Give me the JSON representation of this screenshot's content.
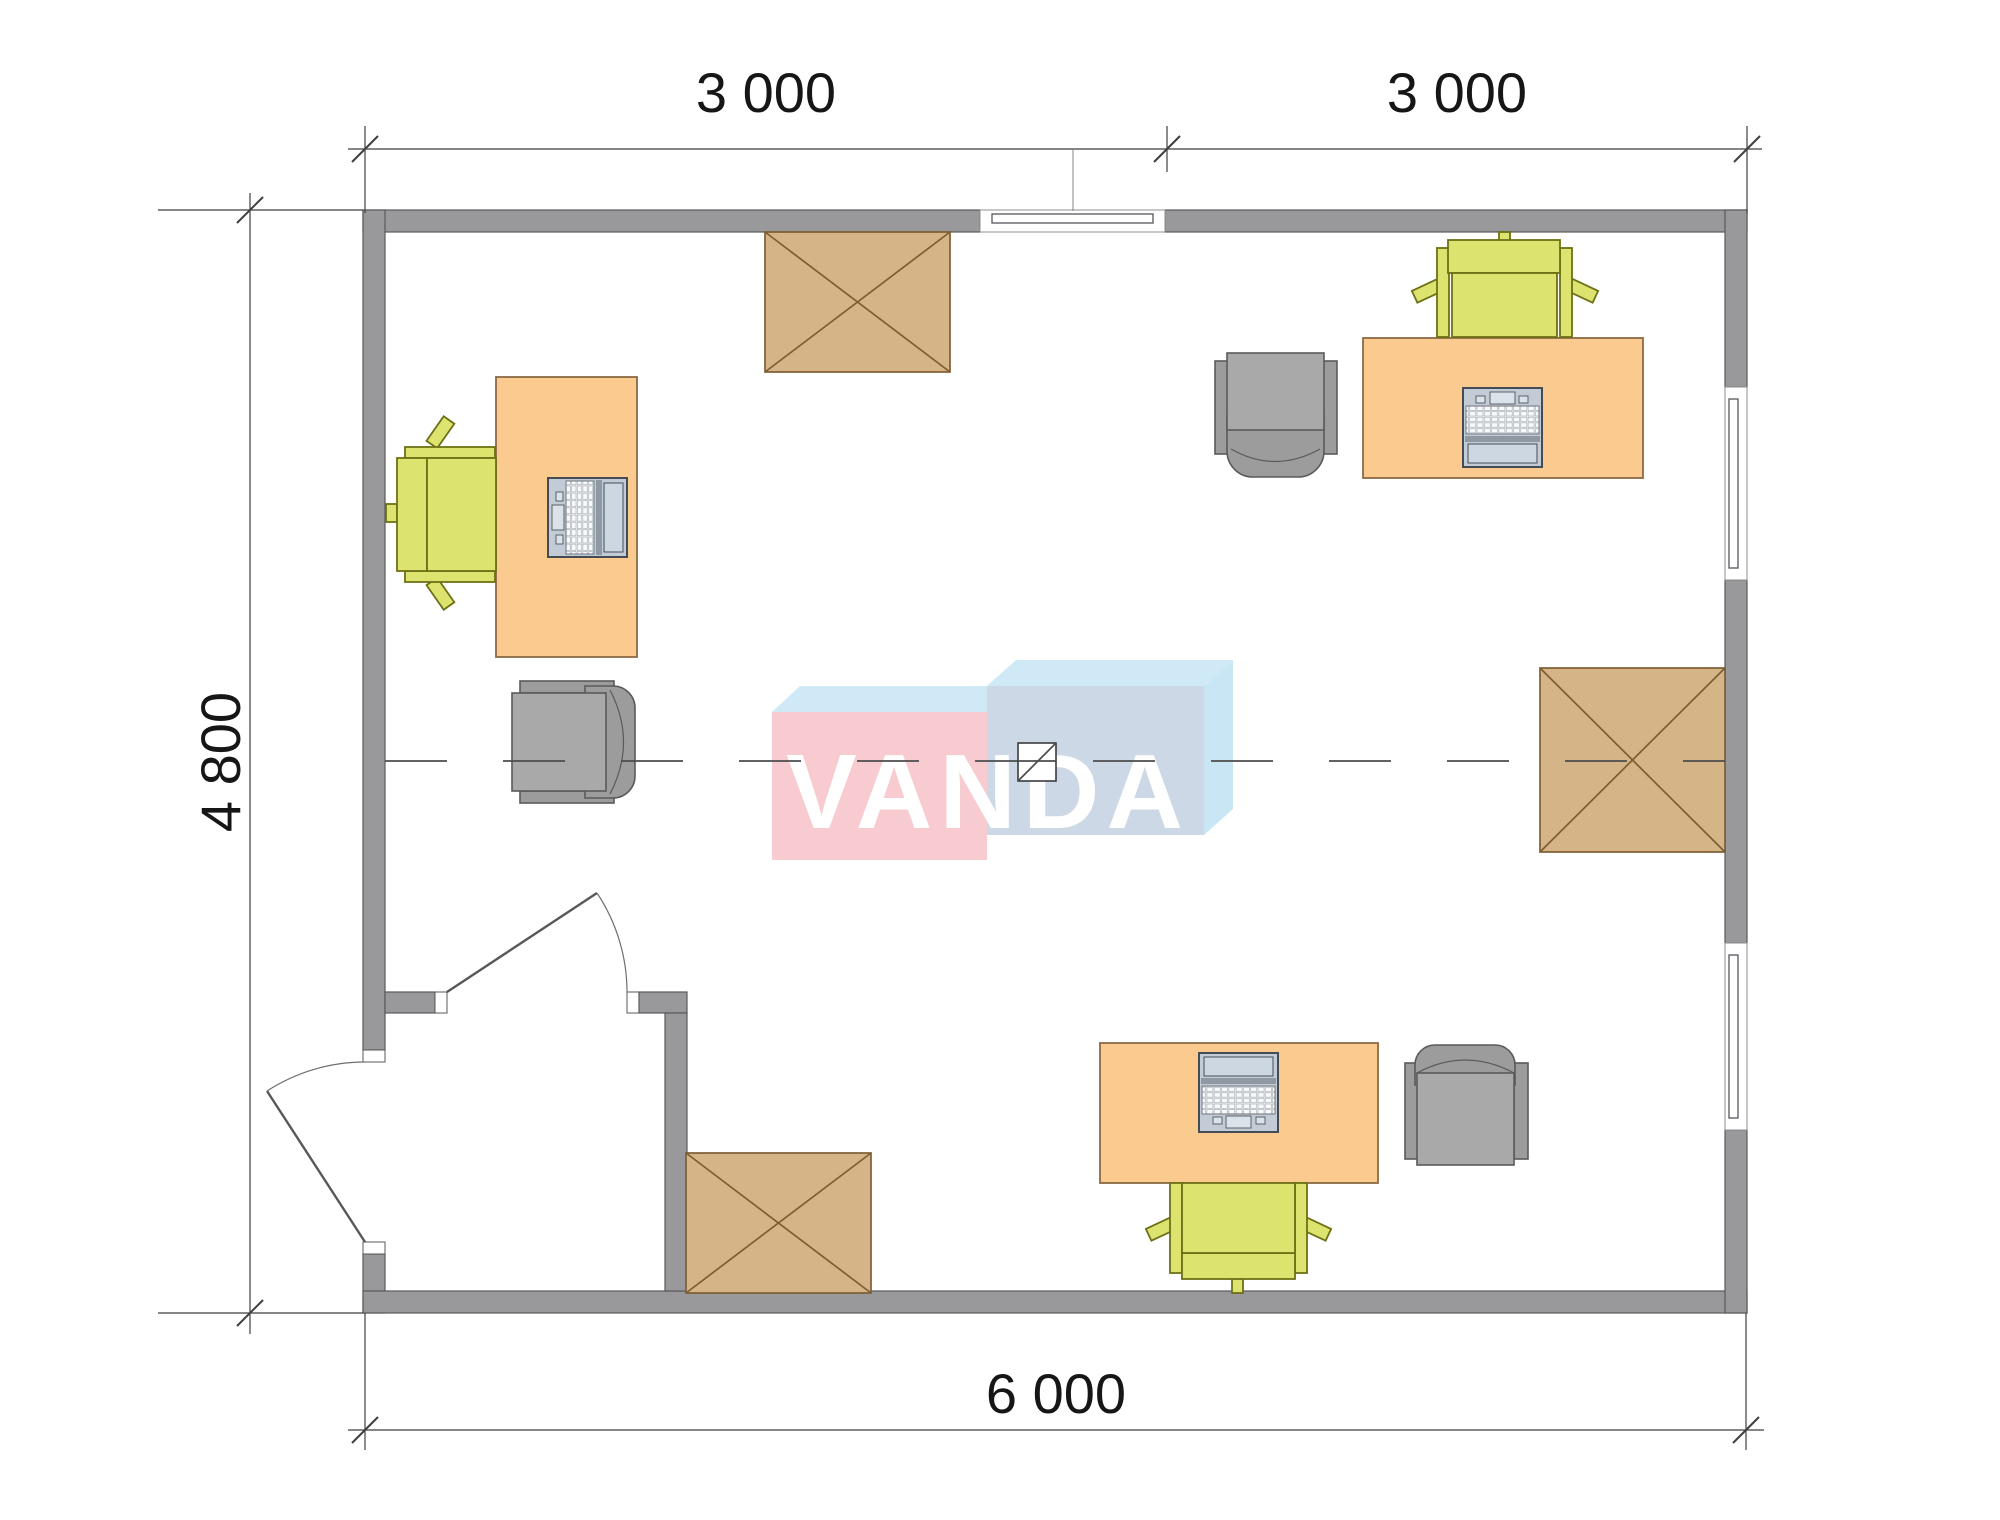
{
  "dimensions": {
    "top_left_span": "3 000",
    "top_right_span": "3 000",
    "left_span": "4 800",
    "bottom_span": "6 000"
  },
  "logo": {
    "text": "VANDA"
  },
  "colors": {
    "wall_fill": "#99989a",
    "wall_stroke": "#5a595b",
    "desk_fill": "#fbca8e",
    "desk_stroke": "#8a6b46",
    "chair_green_fill": "#dce36f",
    "chair_green_stroke": "#6d7114",
    "gray_fill": "#a9a9a9",
    "gray_dark_fill": "#9c9c9c",
    "gray_stroke": "#5a5a5a",
    "box_fill": "#d5b488",
    "box_stroke": "#7d5e33",
    "dim_color": "#3f3f3f",
    "laptop_body": "#c3ccd6",
    "laptop_screen": "#cdd7e1",
    "laptop_stroke": "#454b54",
    "logo_pink": "#f7cbd0",
    "logo_blue_top": "#cfe9f7",
    "logo_blue_front": "#cdd8e6",
    "logo_blue_side": "#c9e6f5"
  },
  "elements": {
    "desks": [
      "desk-top-left",
      "desk-top-right",
      "desk-bottom"
    ],
    "office_chairs": [
      "office-chair-top-left",
      "office-chair-top-right",
      "office-chair-bottom"
    ],
    "guest_chairs": [
      "guest-chair-center-left",
      "guest-chair-top-right",
      "guest-chair-bottom-right"
    ],
    "laptops": [
      "laptop-top-left",
      "laptop-top-right",
      "laptop-bottom"
    ],
    "cabinets": [
      "cabinet-top",
      "cabinet-right",
      "cabinet-bottom-left"
    ],
    "windows": [
      "window-top",
      "window-right-upper",
      "window-right-lower"
    ],
    "doors": [
      "door-interior",
      "door-exterior"
    ]
  }
}
